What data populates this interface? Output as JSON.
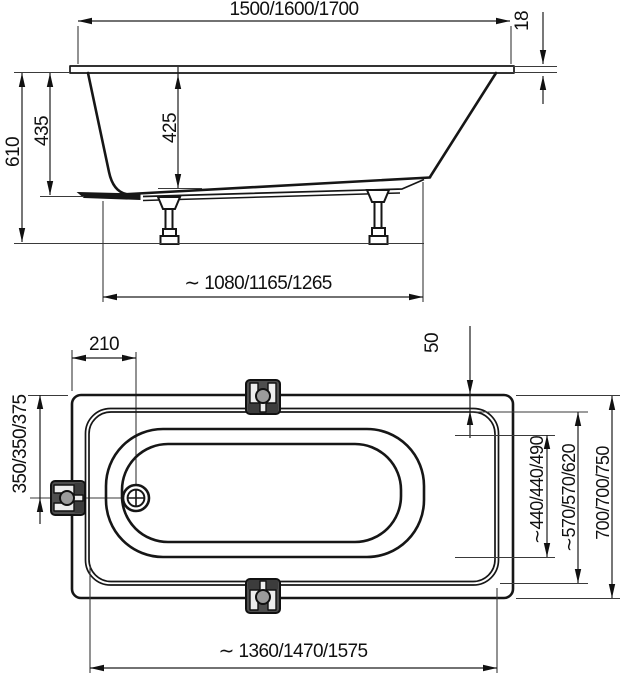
{
  "drawing": {
    "background": "#ffffff",
    "line_color": "#161616",
    "bracket_fill": "#4e4e4e",
    "views": {
      "side": {
        "overall_length": "1500/1600/1700",
        "rim_thickness": "18",
        "overall_height": "610",
        "body_height": "435",
        "inner_depth": "425",
        "base_length": "∼ 1080/1165/1265"
      },
      "plan": {
        "drain_offset_x": "210",
        "rim_width": "50",
        "drain_offset_y": "350/350/375",
        "floor_width": "∼440/440/490",
        "inner_width": "∼570/570/620",
        "overall_width": "700/700/750",
        "inner_length": "∼ 1360/1470/1575"
      }
    }
  }
}
